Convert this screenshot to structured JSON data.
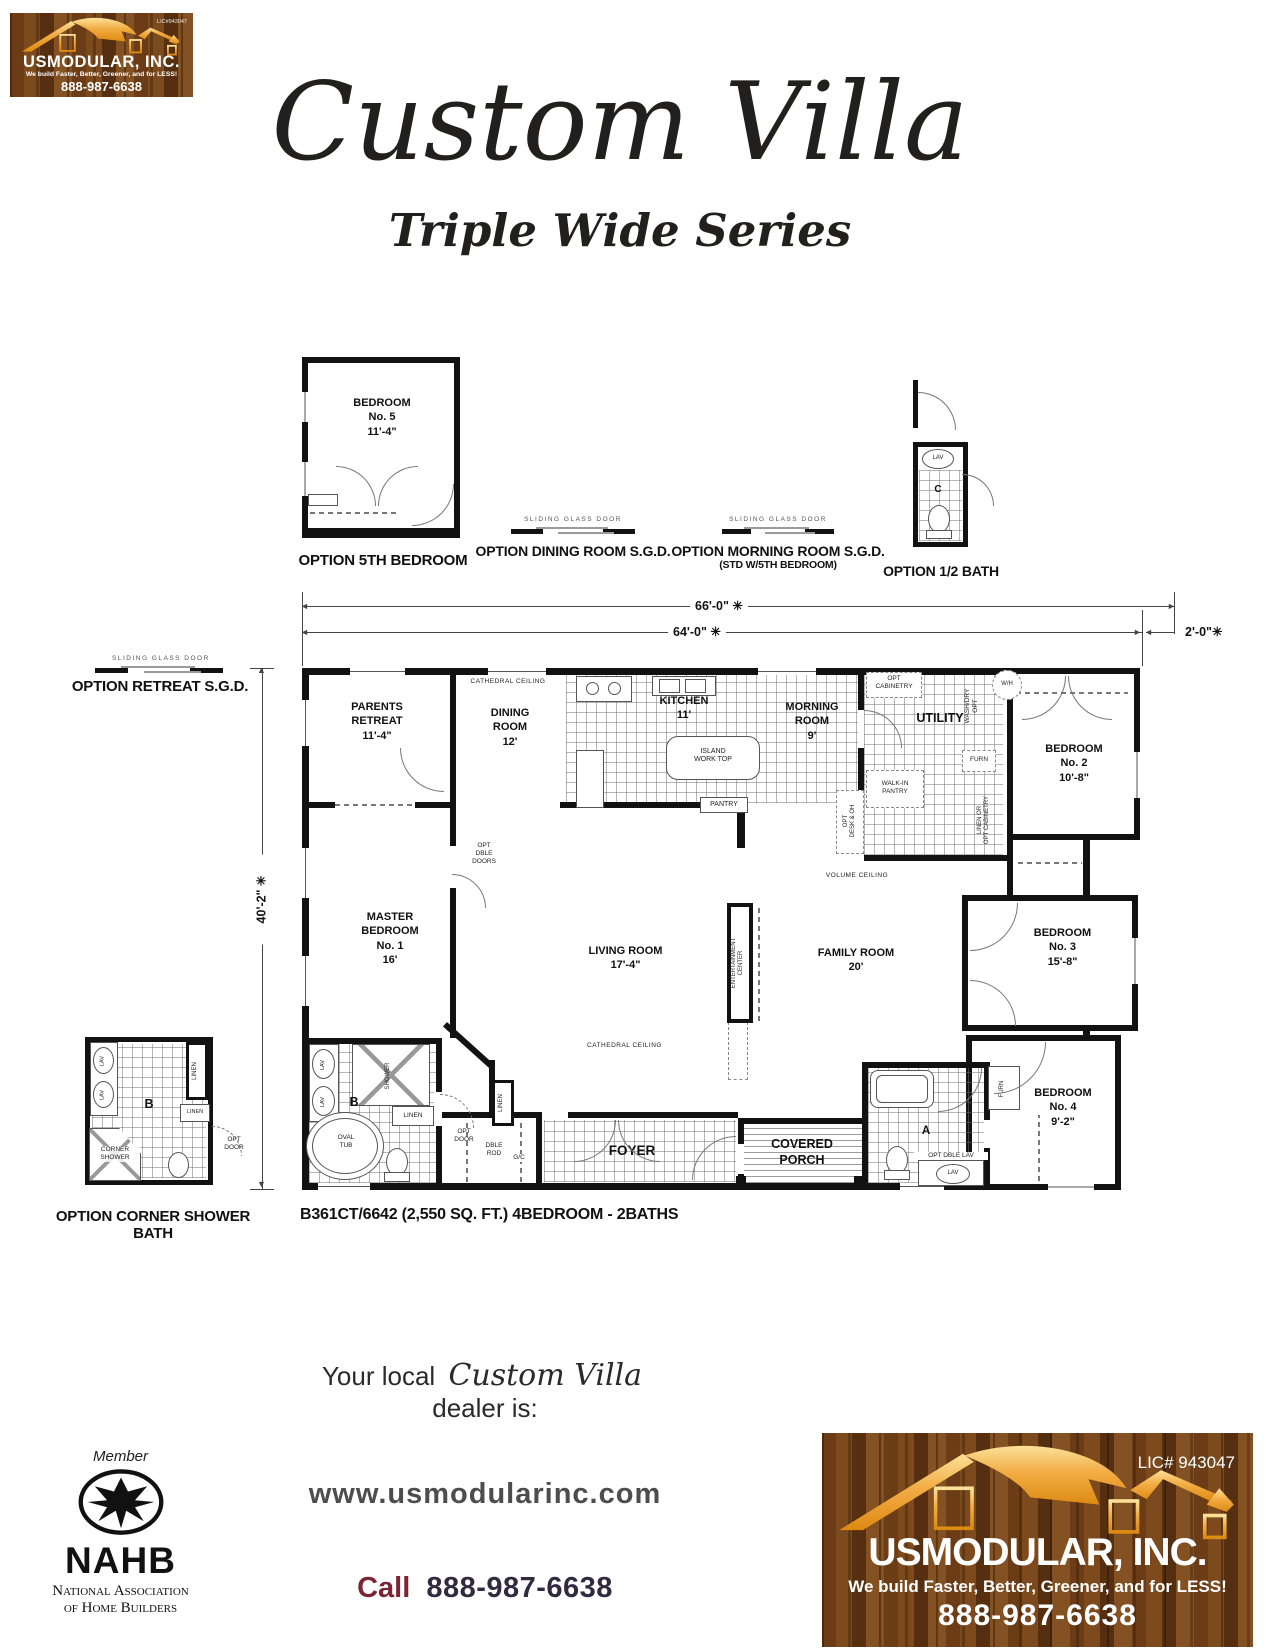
{
  "header": {
    "logo": {
      "company": "USMODULAR, INC.",
      "tagline": "We build Faster, Better, Greener, and for LESS!",
      "phone": "888-987-6638",
      "lic": "LIC#943047"
    },
    "title": "Custom Villa",
    "subtitle": "Triple Wide Series"
  },
  "options": {
    "bedroom5": {
      "label": "BEDROOM\nNo. 5\n11'-4\"",
      "caption": "OPTION 5TH BEDROOM"
    },
    "dining_sgd": {
      "door": "SLIDING GLASS DOOR",
      "caption": "OPTION DINING ROOM S.G.D."
    },
    "morning_sgd": {
      "door": "SLIDING GLASS DOOR",
      "caption": "OPTION MORNING ROOM S.G.D.",
      "subcaption": "(STD W/5TH BEDROOM)"
    },
    "half_bath": {
      "lav": "LAV",
      "room": "C",
      "caption": "OPTION 1/2 BATH"
    },
    "retreat_sgd": {
      "door": "SLIDING GLASS DOOR",
      "caption": "OPTION RETREAT S.G.D."
    },
    "corner_bath": {
      "caption": "OPTION CORNER SHOWER BATH",
      "lav1": "LAV",
      "lav2": "LAV",
      "linen_tall": "LINEN",
      "linen_box": "LINEN",
      "room": "B",
      "opt_door": "OPT\nDOOR",
      "corner_shower": "CORNER\nSHOWER"
    }
  },
  "dimensions": {
    "overall": "66'-0\" ✳",
    "main": "64'-0\" ✳",
    "eave": "2'-0\"✳",
    "depth": "40'-2\" ✳"
  },
  "plan": {
    "caption": "B361CT/6642 (2,550 SQ. FT.) 4BEDROOM - 2BATHS",
    "rooms": {
      "parents_retreat": "PARENTS\nRETREAT\n11'-4\"",
      "dining": "DINING\nROOM\n12'",
      "kitchen": "KITCHEN\n11'",
      "morning": "MORNING\nROOM\n9'",
      "utility": "UTILITY",
      "bedroom2": "BEDROOM\nNo. 2\n10'-8\"",
      "master": "MASTER\nBEDROOM\nNo. 1\n16'",
      "living": "LIVING ROOM\n17'-4\"",
      "family": "FAMILY ROOM\n20'",
      "bedroom3": "BEDROOM\nNo. 3\n15'-8\"",
      "bedroom4": "BEDROOM\nNo. 4\n9'-2\"",
      "foyer": "FOYER",
      "porch": "COVERED\nPORCH",
      "bath_a": "A",
      "bath_b": "B"
    },
    "annotations": {
      "cathedral_dining": "CATHEDRAL CEILING",
      "cathedral_living": "CATHEDRAL CEILING",
      "volume": "VOLUME CEILING",
      "island": "ISLAND\nWORK TOP",
      "pantry": "PANTRY",
      "opt_cabinetry": "OPT\nCABINETRY",
      "walk_in_pantry": "WALK-IN\nPANTRY",
      "opt_desk": "OPT\nDESK & OH",
      "wash_dry": "WASH/DRY\nOPT",
      "wh": "W/H",
      "furn": "FURN",
      "linen_or_opt": "LINEN OR\nOPT CABINETRY",
      "opt_dble_doors": "OPT\nDBLE\nDOORS",
      "entertainment": "ENTERTAINMENT\nCENTER",
      "shower": "SHOWER",
      "linen_hall": "LINEN",
      "linen_bathb": "LINEN",
      "oval_tub": "OVAL\nTUB",
      "opt_door": "OPT\nDOOR",
      "dble_rod": "DBLE\nROD",
      "gc": "G/C",
      "lav1": "LAV",
      "lav2": "LAV",
      "opt_dble_lav": "OPT DBLE LAV",
      "lav_a": "LAV",
      "furn_a": "FURN"
    }
  },
  "footer": {
    "dealer_prefix": "Your local",
    "dealer_name": "Custom Villa",
    "dealer_suffix": "dealer is:",
    "nahb": {
      "member": "Member",
      "acronym": "NAHB",
      "assoc1": "National Association",
      "assoc2": "of Home Builders"
    },
    "website": "www.usmodularinc.com",
    "call_label": "Call",
    "phone": "888-987-6638",
    "logo": {
      "lic": "LIC# 943047",
      "company": "USMODULAR, INC.",
      "tagline": "We build Faster, Better, Greener, and for LESS!",
      "phone": "888-987-6638"
    }
  }
}
